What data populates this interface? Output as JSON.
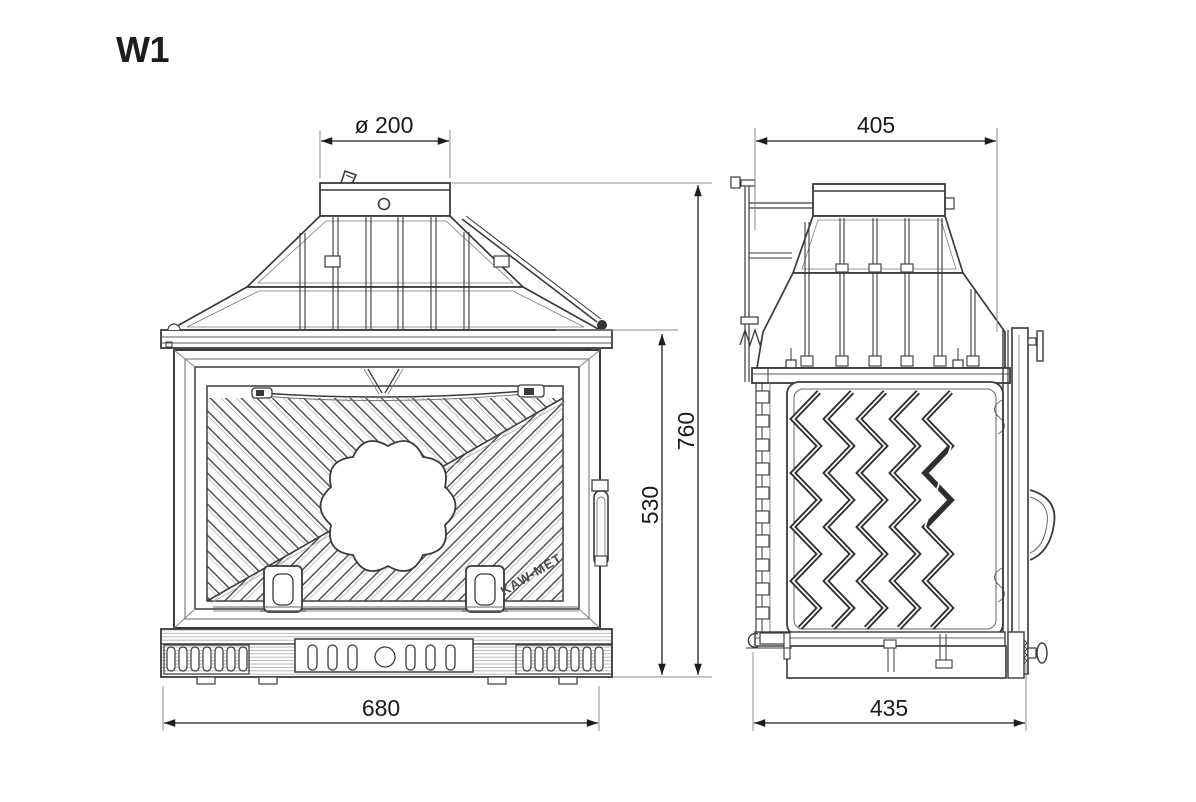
{
  "title": "W1",
  "brand": "KAW-MET",
  "dimensions": {
    "flue_diameter": "ø 200",
    "overall_width": "680",
    "door_height": "530",
    "overall_height": "760",
    "top_depth": "405",
    "base_depth": "435"
  },
  "colors": {
    "background": "#ffffff",
    "line": "#3a3a3a",
    "line_light": "#8c8c8c",
    "dimension_line": "#222222",
    "text": "#1a1a1a"
  }
}
